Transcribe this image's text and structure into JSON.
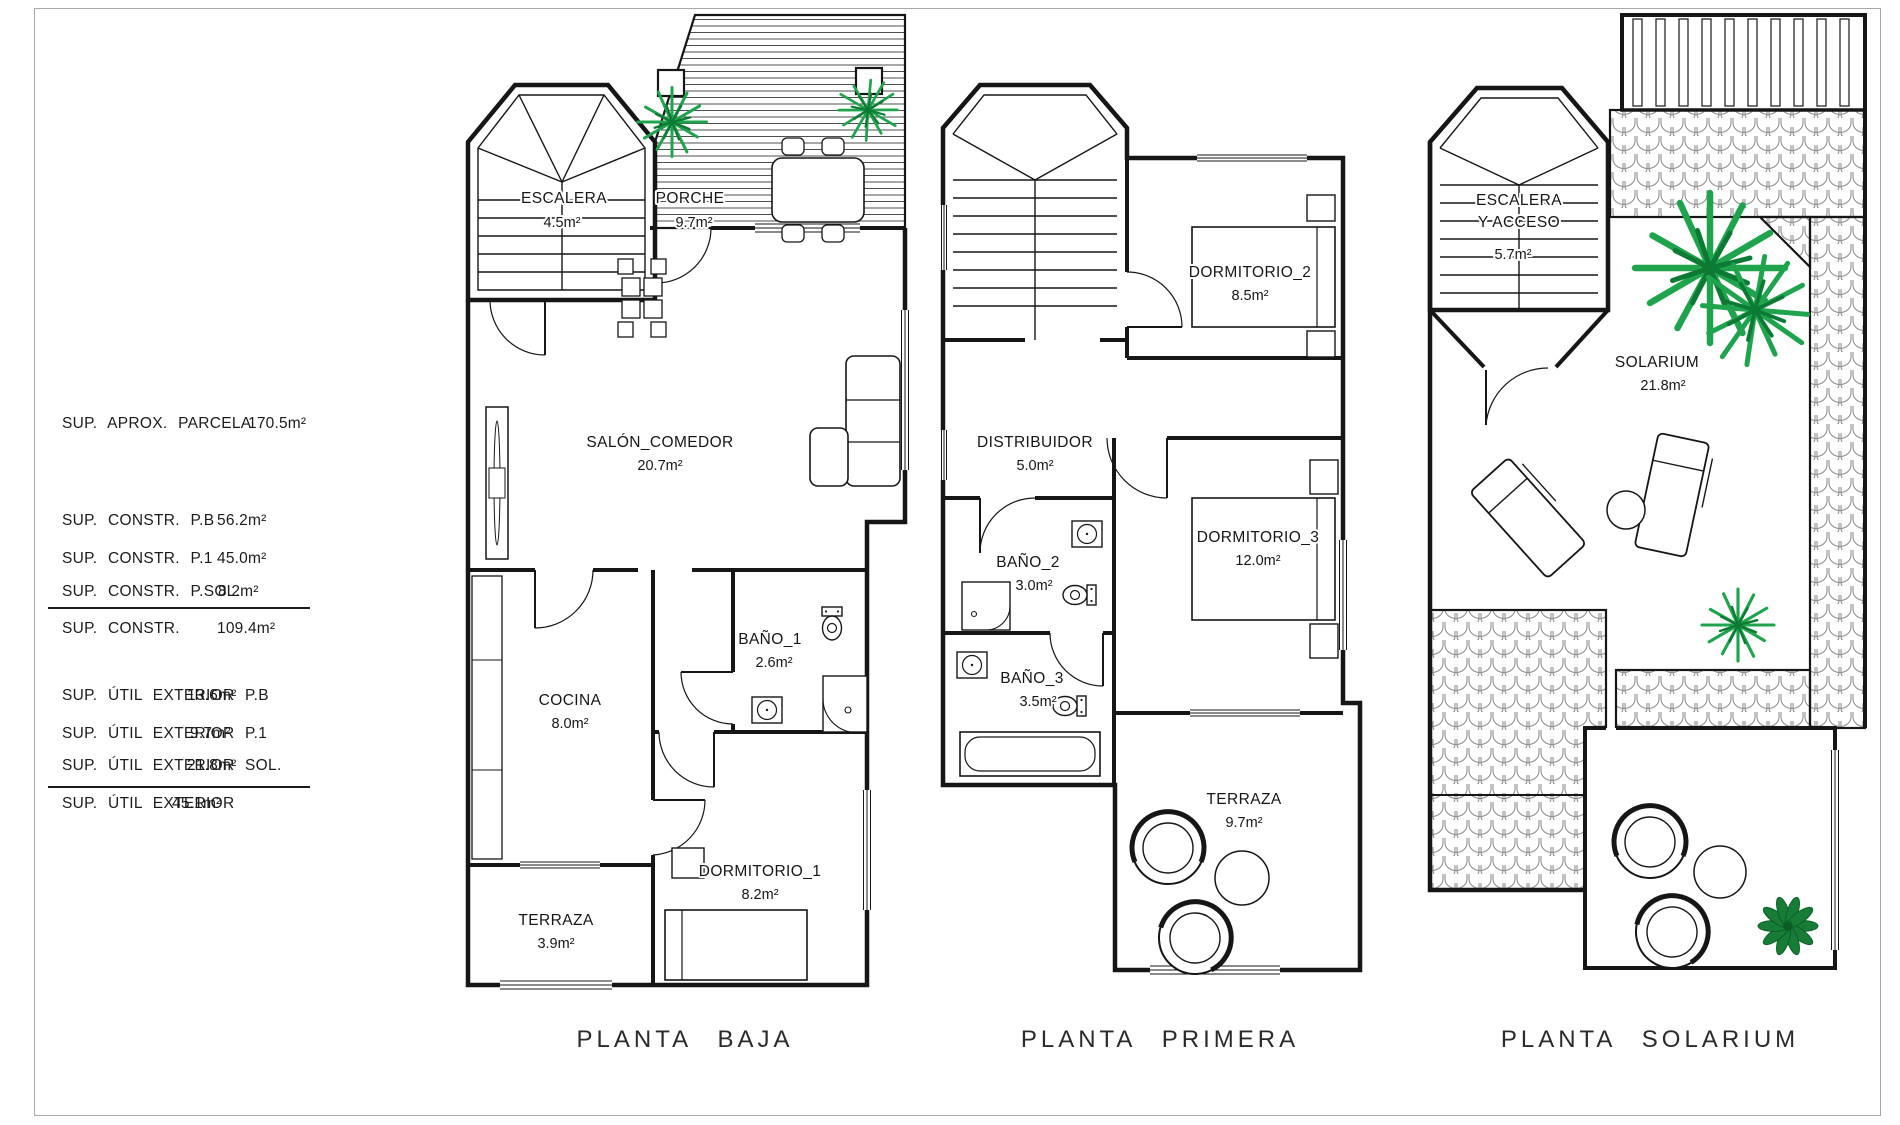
{
  "area_table": {
    "rows": [
      {
        "label": "SUP. APROX. PARCELA",
        "value": "170.5m²"
      },
      {
        "label": "SUP. CONSTR. P.B",
        "value": "56.2m²"
      },
      {
        "label": "SUP. CONSTR. P.1",
        "value": "45.0m²"
      },
      {
        "label": "SUP. CONSTR. P.SOL.",
        "value": "8.2m²"
      },
      {
        "label": "SUP. CONSTR.",
        "value": "109.4m²"
      },
      {
        "label": "SUP. ÚTIL EXTERIOR P.B",
        "value": "13.6m²"
      },
      {
        "label": "SUP. ÚTIL EXTERIOR P.1",
        "value": "9.7m²"
      },
      {
        "label": "SUP. ÚTIL EXTERIOR SOL.",
        "value": "21.8m²"
      },
      {
        "label": "SUP. ÚTIL EXTERIOR",
        "value": "45.1m²"
      }
    ]
  },
  "floors": {
    "baja": {
      "caption": "PLANTA BAJA",
      "rooms": {
        "escalera": {
          "name": "ESCALERA",
          "area": "4.5m²"
        },
        "porche": {
          "name": "PORCHE",
          "area": "9.7m²"
        },
        "salon": {
          "name": "SALÓN_COMEDOR",
          "area": "20.7m²"
        },
        "cocina": {
          "name": "COCINA",
          "area": "8.0m²"
        },
        "bano1": {
          "name": "BAÑO_1",
          "area": "2.6m²"
        },
        "dormitorio1": {
          "name": "DORMITORIO_1",
          "area": "8.2m²"
        },
        "terraza": {
          "name": "TERRAZA",
          "area": "3.9m²"
        }
      }
    },
    "primera": {
      "caption": "PLANTA PRIMERA",
      "rooms": {
        "dormitorio2": {
          "name": "DORMITORIO_2",
          "area": "8.5m²"
        },
        "distribuidor": {
          "name": "DISTRIBUIDOR",
          "area": "5.0m²"
        },
        "bano2": {
          "name": "BAÑO_2",
          "area": "3.0m²"
        },
        "dormitorio3": {
          "name": "DORMITORIO_3",
          "area": "12.0m²"
        },
        "bano3": {
          "name": "BAÑO_3",
          "area": "3.5m²"
        },
        "terraza": {
          "name": "TERRAZA",
          "area": "9.7m²"
        }
      }
    },
    "solarium": {
      "caption": "PLANTA SOLARIUM",
      "rooms": {
        "escalera": {
          "name_line1": "ESCALERA",
          "name_line2": "Y ACCESO",
          "area": "5.7m²"
        },
        "solarium": {
          "name": "SOLARIUM",
          "area": "21.8m²"
        }
      }
    }
  },
  "icons": {
    "palm_plant": "palm-plant-icon",
    "bush_plant": "bush-plant-icon"
  },
  "colors": {
    "plant_green": "#1FA44D",
    "plant_dark_green": "#0D7A33",
    "line_dark": "#161616",
    "hatch_gray": "#8F8F8F"
  }
}
